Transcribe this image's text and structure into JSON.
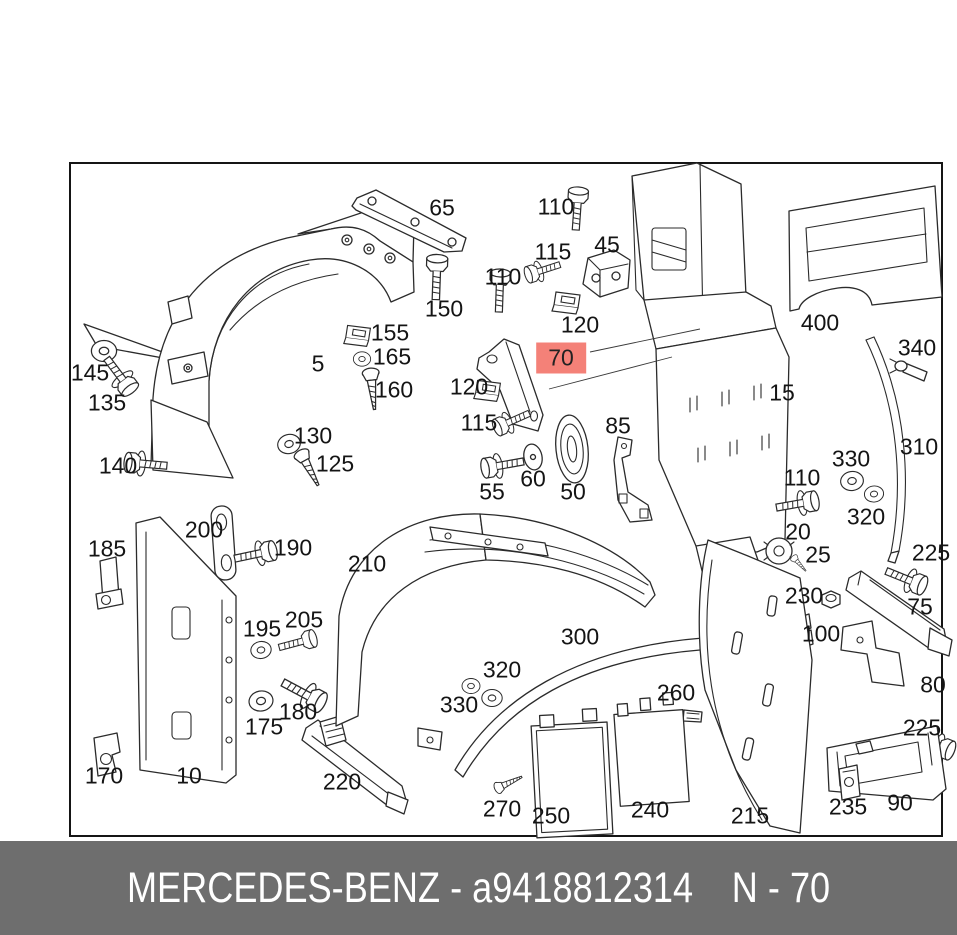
{
  "colors": {
    "highlight": "#f48178",
    "footer_bg": "#6e6e6e",
    "footer_text": "#ffffff",
    "line": "#2b2b2b"
  },
  "footer": {
    "brand": "MERCEDES-BENZ",
    "separator": " - ",
    "part_number": "a9418812314",
    "note": "N - 70"
  },
  "diagram": {
    "highlighted_part": "70",
    "labels": [
      {
        "text": "65",
        "x": 442,
        "y": 208
      },
      {
        "text": "110",
        "x": 556,
        "y": 207
      },
      {
        "text": "45",
        "x": 607,
        "y": 245
      },
      {
        "text": "115",
        "x": 553,
        "y": 252
      },
      {
        "text": "120",
        "x": 580,
        "y": 325
      },
      {
        "text": "110",
        "x": 503,
        "y": 277
      },
      {
        "text": "150",
        "x": 444,
        "y": 309
      },
      {
        "text": "155",
        "x": 390,
        "y": 333
      },
      {
        "text": "165",
        "x": 392,
        "y": 357
      },
      {
        "text": "5",
        "x": 318,
        "y": 364
      },
      {
        "text": "160",
        "x": 394,
        "y": 390
      },
      {
        "text": "145",
        "x": 90,
        "y": 373
      },
      {
        "text": "135",
        "x": 107,
        "y": 403
      },
      {
        "text": "130",
        "x": 313,
        "y": 436
      },
      {
        "text": "125",
        "x": 335,
        "y": 464
      },
      {
        "text": "140",
        "x": 118,
        "y": 466
      },
      {
        "text": "70",
        "x": 561,
        "y": 358,
        "highlight": true
      },
      {
        "text": "120",
        "x": 469,
        "y": 387
      },
      {
        "text": "115",
        "x": 479,
        "y": 423
      },
      {
        "text": "85",
        "x": 618,
        "y": 426
      },
      {
        "text": "55",
        "x": 492,
        "y": 492
      },
      {
        "text": "60",
        "x": 533,
        "y": 479
      },
      {
        "text": "50",
        "x": 573,
        "y": 492
      },
      {
        "text": "15",
        "x": 782,
        "y": 393
      },
      {
        "text": "400",
        "x": 820,
        "y": 323
      },
      {
        "text": "340",
        "x": 917,
        "y": 348
      },
      {
        "text": "330",
        "x": 851,
        "y": 459
      },
      {
        "text": "320",
        "x": 866,
        "y": 517
      },
      {
        "text": "310",
        "x": 919,
        "y": 447
      },
      {
        "text": "110",
        "x": 802,
        "y": 478
      },
      {
        "text": "20",
        "x": 798,
        "y": 532
      },
      {
        "text": "25",
        "x": 818,
        "y": 555
      },
      {
        "text": "230",
        "x": 804,
        "y": 596
      },
      {
        "text": "100",
        "x": 821,
        "y": 634
      },
      {
        "text": "225",
        "x": 931,
        "y": 553
      },
      {
        "text": "75",
        "x": 920,
        "y": 607
      },
      {
        "text": "80",
        "x": 933,
        "y": 685
      },
      {
        "text": "225",
        "x": 922,
        "y": 728
      },
      {
        "text": "200",
        "x": 204,
        "y": 530
      },
      {
        "text": "190",
        "x": 293,
        "y": 548
      },
      {
        "text": "185",
        "x": 107,
        "y": 549
      },
      {
        "text": "210",
        "x": 367,
        "y": 564
      },
      {
        "text": "195",
        "x": 262,
        "y": 629
      },
      {
        "text": "205",
        "x": 304,
        "y": 620
      },
      {
        "text": "300",
        "x": 580,
        "y": 637
      },
      {
        "text": "320",
        "x": 502,
        "y": 670
      },
      {
        "text": "330",
        "x": 459,
        "y": 705
      },
      {
        "text": "260",
        "x": 676,
        "y": 693
      },
      {
        "text": "175",
        "x": 264,
        "y": 727
      },
      {
        "text": "180",
        "x": 298,
        "y": 712
      },
      {
        "text": "170",
        "x": 104,
        "y": 776
      },
      {
        "text": "10",
        "x": 189,
        "y": 776
      },
      {
        "text": "220",
        "x": 342,
        "y": 782
      },
      {
        "text": "270",
        "x": 502,
        "y": 809
      },
      {
        "text": "250",
        "x": 551,
        "y": 816
      },
      {
        "text": "240",
        "x": 650,
        "y": 810
      },
      {
        "text": "215",
        "x": 750,
        "y": 816
      },
      {
        "text": "235",
        "x": 848,
        "y": 807
      },
      {
        "text": "90",
        "x": 900,
        "y": 803
      }
    ]
  }
}
